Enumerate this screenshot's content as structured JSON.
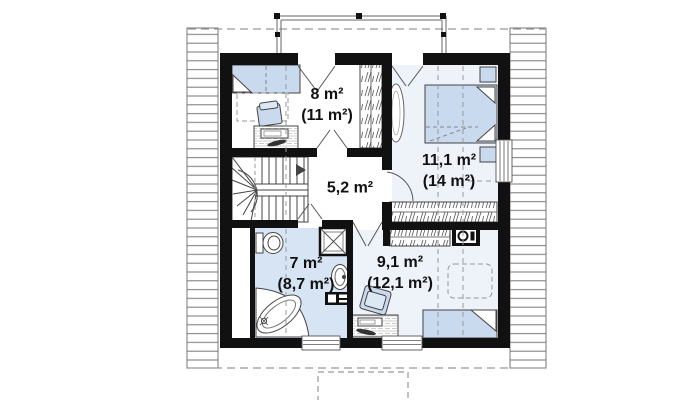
{
  "plan": {
    "type": "attic-floor-plan",
    "rooms": [
      {
        "name": "bedroom-top-left",
        "area": "8 m²",
        "area_note": "(11 m²)"
      },
      {
        "name": "bedroom-right",
        "area": "11,1 m²",
        "area_note": "(14 m²)"
      },
      {
        "name": "hall",
        "area": "5,2 m²",
        "area_note": ""
      },
      {
        "name": "bathroom",
        "area": "7 m²",
        "area_note": "(8,7 m²)"
      },
      {
        "name": "bedroom-bottom",
        "area": "9,1 m²",
        "area_note": "(12,1 m²)"
      }
    ],
    "fixtures": [
      "stairs",
      "bed",
      "double-bed",
      "desk",
      "chair",
      "wardrobe",
      "toilet",
      "corner-bathtub",
      "shower",
      "sink",
      "washer",
      "nightstand"
    ],
    "colors": {
      "wall": "#111111",
      "furniture_fill": "#c9daee",
      "bathroom_floor": "#d6e4f3",
      "room_floor": "#eef2f9",
      "line": "#555555",
      "dashed_line": "#999999",
      "eaves_line": "#777777"
    }
  }
}
